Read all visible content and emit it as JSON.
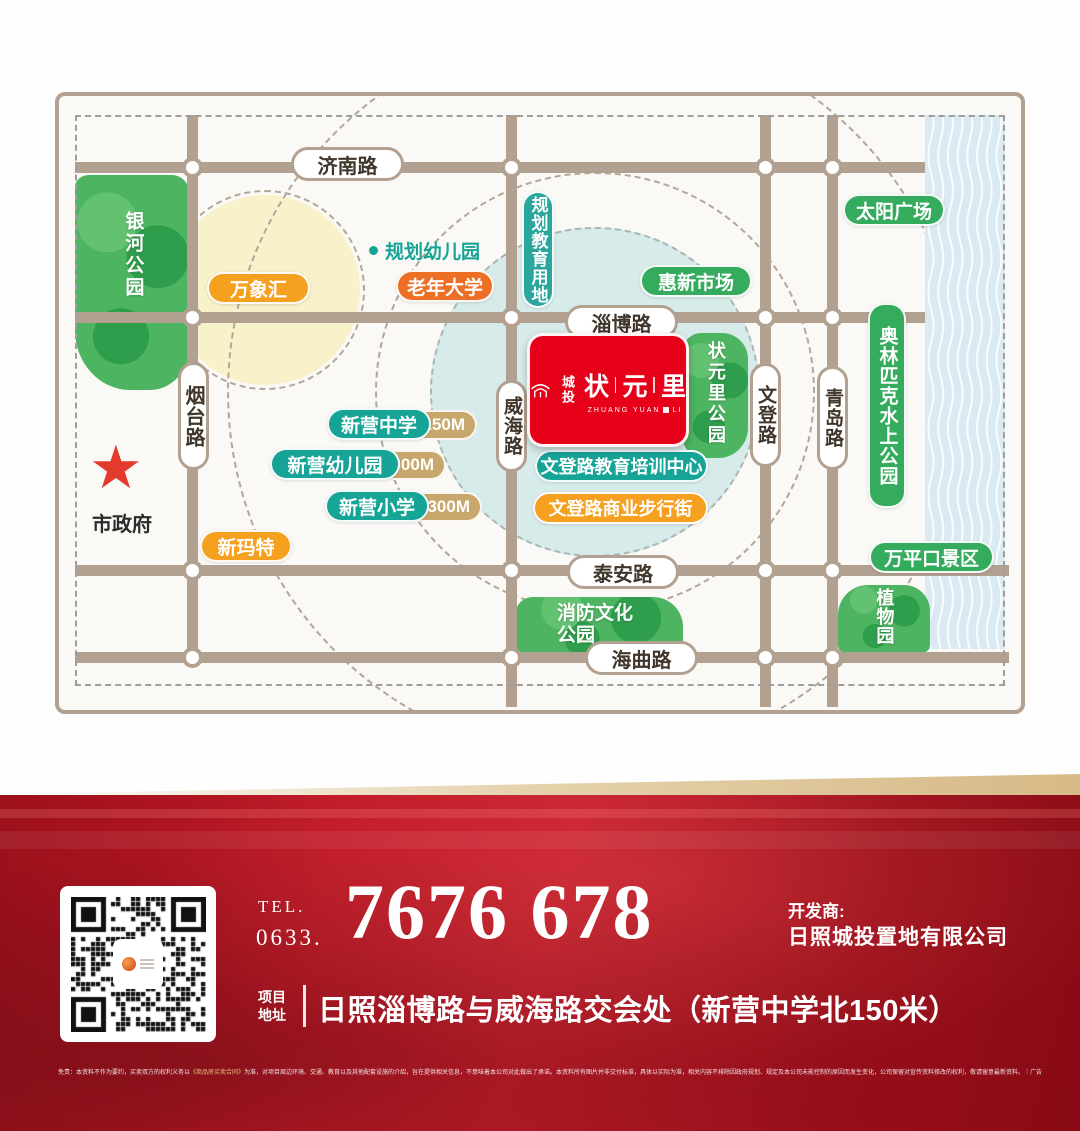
{
  "map": {
    "roads": {
      "jinan": "济南路",
      "zibo": "淄博路",
      "taian": "泰安路",
      "haiqu": "海曲路",
      "yantai": "烟台路",
      "weihai": "威海路",
      "wendeng": "文登路",
      "qingdao": "青岛路"
    },
    "parks": {
      "yinhe": "银河公园",
      "zhuangyuanli_park": "状元里公园",
      "xiaofang": "消防文化公园",
      "zhiwuyuan": "植物园"
    },
    "pois": {
      "wanxianghui": "万象汇",
      "laonian_daxue": "老年大学",
      "guihua_youeryuan": "规划幼儿园",
      "guihua_jiaoyu": "规划教育用地",
      "huixin_shichang": "惠新市场",
      "taiyang_guangchang": "太阳广场",
      "aolinpike": "奥林匹克水上公园",
      "xinying_zhongxue": "新营中学",
      "xinying_youeryuan": "新营幼儿园",
      "xinying_xiaoxue": "新营小学",
      "wendeng_jiaoyu": "文登路教育培训中心",
      "wendeng_shangye": "文登路商业步行街",
      "xinmate": "新玛特",
      "wanpingkou": "万平口景区",
      "shizhengfu": "市政府"
    },
    "distances": {
      "zhongxue": "150M",
      "youeryuan": "300M",
      "xiaoxue": "300M"
    },
    "project": {
      "brand": "城投",
      "name_chars": [
        "状",
        "元",
        "里"
      ],
      "latin_left": "ZHUANG YUAN",
      "latin_right": "LI"
    }
  },
  "banner": {
    "tel_label": "TEL.",
    "tel_prefix": "0633.",
    "phone": "7676 678",
    "developer_label": "开发商:",
    "developer": "日照城投置地有限公司",
    "address_label_top": "项目",
    "address_label_bottom": "地址",
    "address": "日照淄博路与威海路交会处（新营中学北150米）",
    "disclaimer_pre": "免责：本资料不作为要约，买卖双方的权利义务以",
    "disclaimer_contract": "《商品房买卖合同》",
    "disclaimer_post": "为准，对项目周边环境、交通、教育以及其他配套设施的介绍，旨在提供相关信息，不意味着本公司对此做出了承诺。本资料所有图片并非交付标准，具体以实际为准，相关内容不排除因政府规划、规定及本公司未能控制的原因而发生变化，公司保留对宣传资料修改的权利，敬请留意最新资料。｜广告"
  },
  "colors": {
    "accent_red": "#e60019",
    "banner_red": "#a61320",
    "teal": "#16a496",
    "green": "#35ab5d",
    "orange": "#f5a01f",
    "vermilion": "#ed6f26",
    "road_tan": "#b2a091",
    "distance_tan": "#c7a76b",
    "gold_band": "#d6ba87"
  }
}
